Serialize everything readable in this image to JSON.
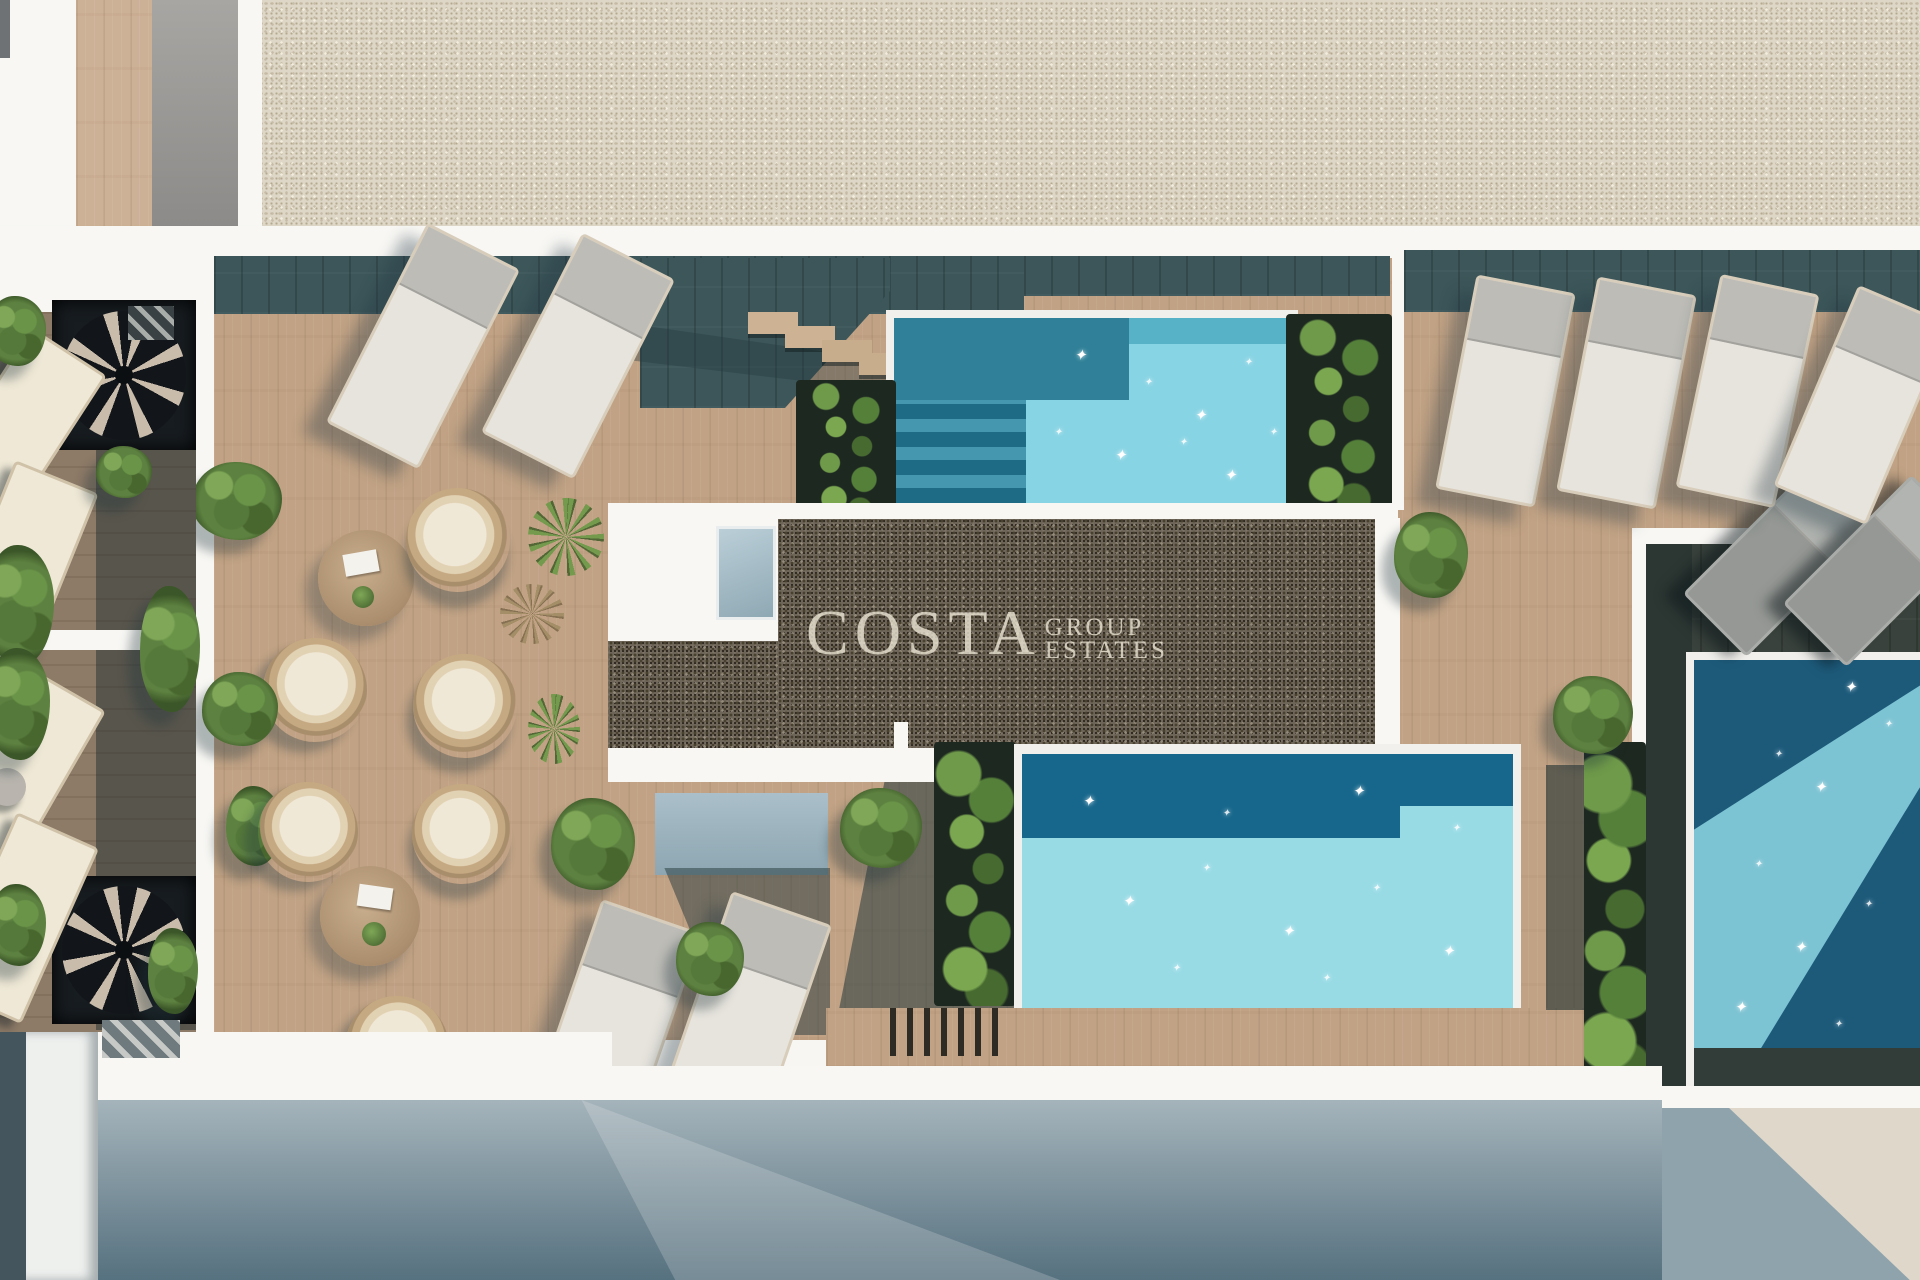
{
  "watermark": {
    "brand": "COSTA",
    "line1": "GROUP",
    "line2": "ESTATES"
  },
  "scene": {
    "description": "Top-down 3D architectural render of a rooftop terrace with swimming pools, wooden decks, sun loungers, lounge chairs and planters",
    "pool_count": 3,
    "sun_lounger_count": 14,
    "round_lounge_chair_count": 6,
    "coffee_table_count": 2,
    "spiral_staircase_count": 2
  },
  "palette": {
    "pool_light_turquoise": "#8ad5e4",
    "pool_mid_teal": "#2f8098",
    "pool_navy": "#17678c",
    "pool_dark_navy": "#1d5a7a",
    "deck_wood": "#c1a284",
    "deck_shade_teal": "#3c5659",
    "gravel_light": "#ded6c6",
    "gravel_dark": "#6e6559",
    "plant_green": "#5d8140",
    "ground_shadow_slate": "#56717f",
    "ground_light_beige": "#ded7ca",
    "wall_white": "#f8f7f4"
  }
}
